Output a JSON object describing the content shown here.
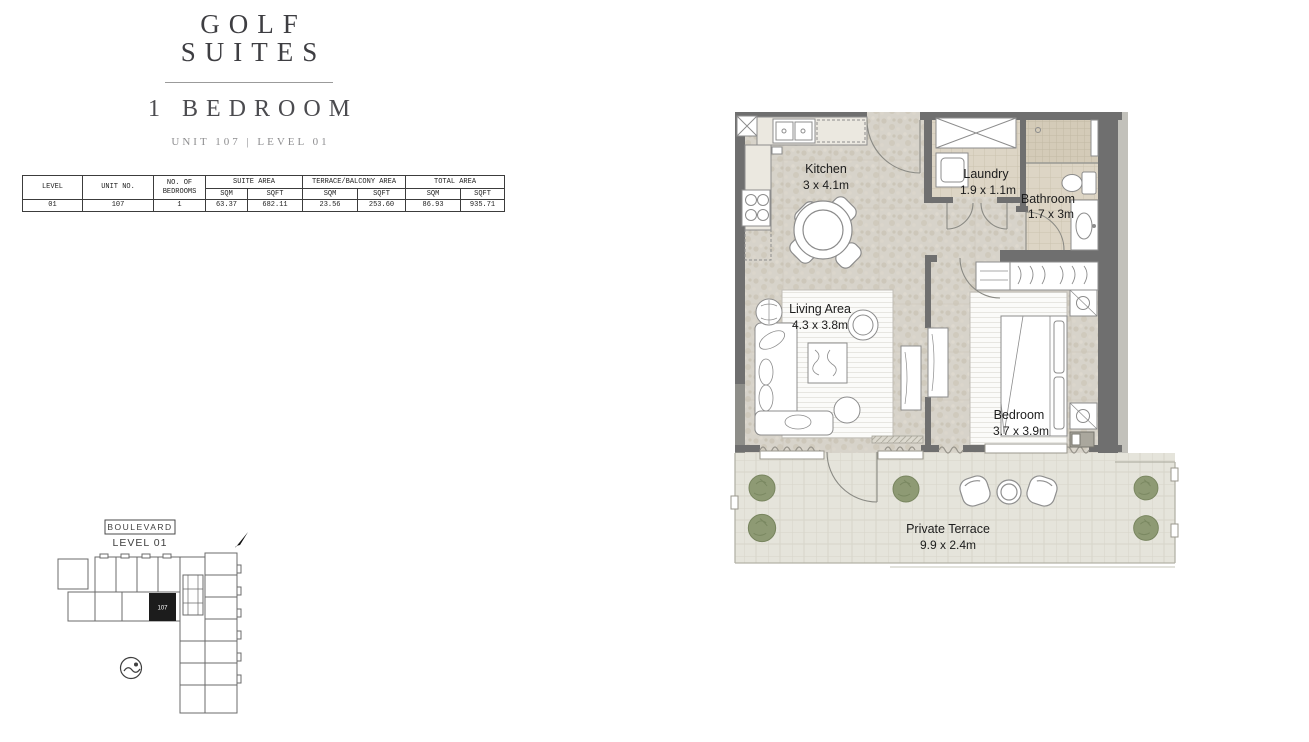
{
  "brand": {
    "line1": "GOLF",
    "line2": "SUITES"
  },
  "plan": {
    "type": "1 BEDROOM",
    "unit_info": "UNIT 107 | LEVEL 01"
  },
  "area_table": {
    "col_level": "LEVEL",
    "col_unit": "UNIT NO.",
    "col_bedrooms": "NO. OF BEDROOMS",
    "col_suite": "SUITE AREA",
    "col_terrace": "TERRACE/BALCONY AREA",
    "col_total": "TOTAL AREA",
    "sqm": "SQM",
    "sqft": "SQFT",
    "row": {
      "level": "01",
      "unit": "107",
      "bedrooms": "1",
      "suite_sqm": "63.37",
      "suite_sqft": "682.11",
      "terrace_sqm": "23.56",
      "terrace_sqft": "253.60",
      "total_sqm": "86.93",
      "total_sqft": "935.71"
    }
  },
  "floor_plan": {
    "rooms": [
      {
        "name": "Kitchen",
        "dims": "3 x 4.1m"
      },
      {
        "name": "Laundry",
        "dims": "1.9 x 1.1m"
      },
      {
        "name": "Bathroom",
        "dims": "1.7 x 3m"
      },
      {
        "name": "Living Area",
        "dims": "4.3 x 3.8m"
      },
      {
        "name": "Bedroom",
        "dims": "3.7 x 3.9m"
      },
      {
        "name": "Private Terrace",
        "dims": "9.9 x 2.4m"
      }
    ]
  },
  "site_plan": {
    "street": "BOULEVARD",
    "level": "LEVEL 01",
    "unit": "107",
    "icons": {
      "pool": "swimmer-icon",
      "north": "north-arrow-icon"
    }
  },
  "colors": {
    "wall": "#6f6f6f",
    "floor_stone": "#d7d3ca",
    "room_tile": "#ddd5c5",
    "terrace": "#e5e4db",
    "tree": "#8e9a74",
    "text": "#1c1c1c"
  }
}
